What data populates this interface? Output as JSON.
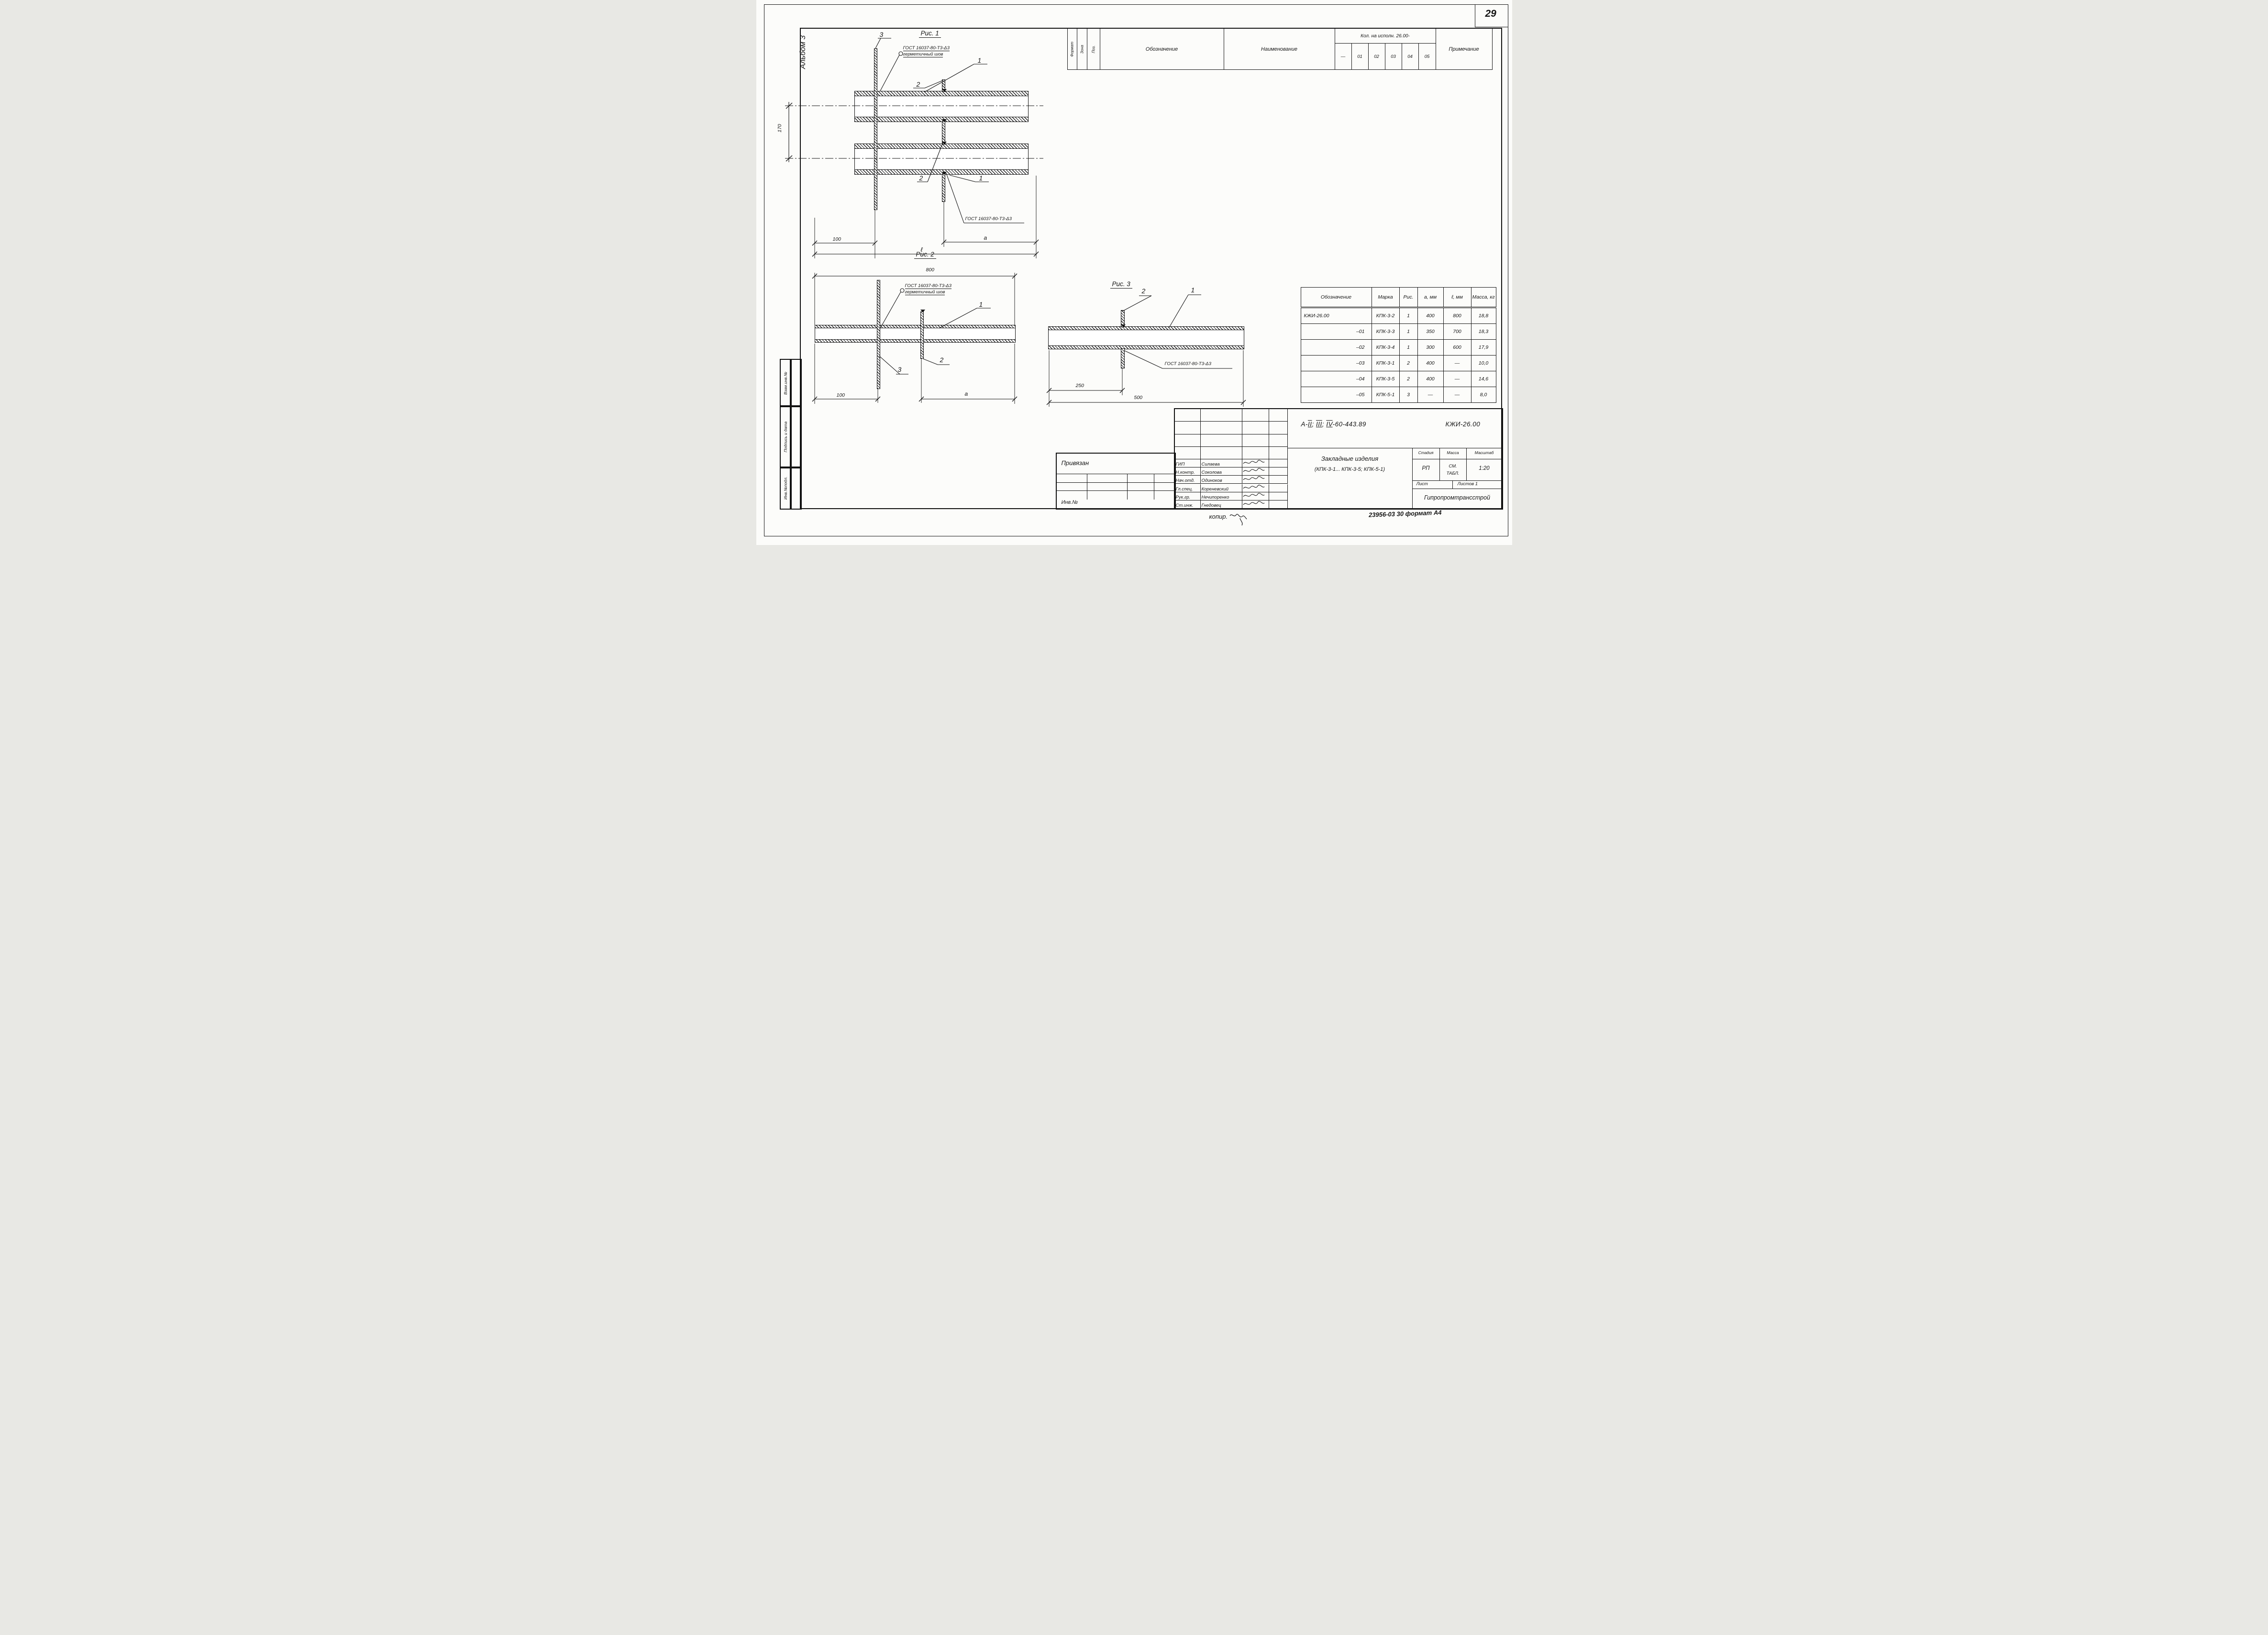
{
  "page": {
    "number": "29",
    "album": "Альбом 3",
    "copy_note": "копир.",
    "archive_code": "23956-03  30  формат А4"
  },
  "margin_stack": [
    {
      "label": "Взам.инв.№"
    },
    {
      "label": "Подпись и дата"
    },
    {
      "label": "Инв.№подл."
    }
  ],
  "spec_table": {
    "col_headers": {
      "format": "Формат",
      "zone": "Зона",
      "pos": "Поз.",
      "designation": "Обозначение",
      "name": "Наименование",
      "qty_group": "Кол. на исполн. 26.00-",
      "qty_cols": [
        "—",
        "01",
        "02",
        "03",
        "04",
        "05"
      ],
      "note": "Примечание"
    },
    "rows": [
      {
        "type": "section",
        "name": "Документация"
      },
      {
        "type": "item",
        "format": "А3",
        "zone": "",
        "pos": "",
        "designation": "КЖИ-ТТ",
        "name": "Технические требования",
        "crossed": true,
        "qty": [
          "",
          "",
          "",
          "",
          "",
          ""
        ],
        "note": ""
      },
      {
        "type": "section",
        "name": "Детали"
      },
      {
        "type": "item",
        "format": "Б.Ч.",
        "zone": "",
        "pos": "1",
        "designation": "",
        "name": "Труба",
        "frac_top": "45х2 ГОСТ 10704-76",
        "frac_bottom": "ВСт3сп ГОСТ 10705-63*",
        "qty": [
          "2",
          "2",
          "2",
          "",
          "",
          ""
        ],
        "note": ""
      },
      {
        "type": "item",
        "format": "Б.Ч.",
        "zone": "",
        "pos": "",
        "designation": "",
        "name": "Труба  15 ГОСТ 3262-75;  ℓ=800",
        "qty": [
          "",
          "",
          "",
          "1",
          "",
          ""
        ],
        "note": ""
      },
      {
        "type": "item",
        "format": "Б.Ч.",
        "zone": "",
        "pos": "",
        "designation": "",
        "name": "Труба",
        "frac_top": "57х3,5 ГОСТ 8732-78",
        "frac_bottom": "ВСт2сп ГОСТ 8731-74",
        "qty": [
          "",
          "",
          "",
          "",
          "1",
          ""
        ],
        "note": ""
      },
      {
        "type": "item",
        "format": "Б.Ч.",
        "zone": "",
        "pos": "",
        "designation": "",
        "name": "Труба",
        "frac_top": "127х4 ГОСТ 8732-78",
        "frac_bottom": "ВСт2сп ГОСТ 8731-74*",
        "qty": [
          "",
          "",
          "",
          "",
          "",
          "1"
        ],
        "note": ""
      },
      {
        "type": "item",
        "format": "",
        "zone": "",
        "pos": "2",
        "designation": "03.005-5; Т-199.250.09.001",
        "name": "Ограничитель",
        "qty": [
          "2",
          "2",
          "2",
          "",
          "",
          ""
        ],
        "note": ""
      },
      {
        "type": "item",
        "format": "",
        "zone": "",
        "pos": "",
        "designation": "″   Т-199.250.11.001",
        "name": "Ограничитель",
        "qty": [
          "",
          "",
          "",
          "1",
          "",
          ""
        ],
        "note": ""
      },
      {
        "type": "item",
        "format": "",
        "zone": "",
        "pos": "",
        "designation": "″   Т-199.250.09.001-12",
        "name": "Ограничитель",
        "qty": [
          "",
          "",
          "",
          "",
          "1",
          ""
        ],
        "note": ""
      },
      {
        "type": "item",
        "format": "",
        "zone": "",
        "pos": "",
        "designation": "КЖИ-24.00-04",
        "name": "Ограничитель О-1",
        "qty": [
          "",
          "",
          "",
          "",
          "",
          "1"
        ],
        "note": ""
      },
      {
        "type": "item",
        "format": "",
        "zone": "",
        "pos": "3",
        "designation": "–03",
        "name": "Пластина  П-5",
        "qty": [
          "1",
          "1",
          "1",
          "",
          "",
          ""
        ],
        "note": ""
      },
      {
        "type": "item",
        "format": "",
        "zone": "",
        "pos": "",
        "designation": "–02",
        "name": "″       П-4",
        "qty": [
          "",
          "",
          "",
          "1",
          "",
          ""
        ],
        "note": ""
      },
      {
        "type": "item",
        "format": "",
        "zone": "",
        "pos": "",
        "designation": "03.005-5; Т-199.250.07.003-15",
        "name": "Пластина",
        "qty": [
          "",
          "",
          "",
          "",
          "1",
          ""
        ],
        "note": ""
      }
    ]
  },
  "param_table": {
    "headers": {
      "designation": "Обозначение",
      "mark": "Марка",
      "fig": "Рис.",
      "a": "а, мм",
      "l": "ℓ, мм",
      "mass": "Масса, кг"
    },
    "rows": [
      {
        "designation": "КЖИ-26.00",
        "mark": "КПК-3-2",
        "fig": "1",
        "a": "400",
        "l": "800",
        "mass": "18,8"
      },
      {
        "designation": "–01",
        "mark": "КПК-3-3",
        "fig": "1",
        "a": "350",
        "l": "700",
        "mass": "18,3"
      },
      {
        "designation": "–02",
        "mark": "КПК-3-4",
        "fig": "1",
        "a": "300",
        "l": "600",
        "mass": "17,9"
      },
      {
        "designation": "–03",
        "mark": "КПК-3-1",
        "fig": "2",
        "a": "400",
        "l": "—",
        "mass": "10,0"
      },
      {
        "designation": "–04",
        "mark": "КПК-3-5",
        "fig": "2",
        "a": "400",
        "l": "—",
        "mass": "14,6"
      },
      {
        "designation": "–05",
        "mark": "КПК-5-1",
        "fig": "3",
        "a": "—",
        "l": "—",
        "mass": "8,0"
      }
    ]
  },
  "figures": {
    "fig1": {
      "title": "Рис. 1",
      "label_pipe": "1",
      "label_bar": "2",
      "label_plate": "3",
      "weld_gost": "ГОСТ 16037-80-Т3-Δ3",
      "weld_note": "герметичный шов",
      "gost_note": "ГОСТ 16037-80-Т3-Δ3",
      "dim_height": "170",
      "dim_left": "100",
      "dim_a": "а",
      "dim_total": "ℓ"
    },
    "fig2": {
      "title": "Рис. 2",
      "dim_top": "800",
      "label_pipe": "1",
      "label_bar": "2",
      "label_plate": "3",
      "weld_gost": "ГОСТ 16037-80-Т3-Δ3",
      "weld_note": "герметичный шов",
      "dim_left": "100",
      "dim_a": "а"
    },
    "fig3": {
      "title": "Рис. 3",
      "label_pipe": "1",
      "label_bar": "2",
      "gost_note": "ГОСТ 16037-80-Т3-Δ3",
      "dim_left": "250",
      "dim_total": "500"
    }
  },
  "title_block": {
    "doc": {
      "prefix": "А-",
      "romans": [
        "II",
        "III",
        "IV"
      ],
      "suffix": "-60-443.89",
      "code": "КЖИ-26.00"
    },
    "title": "Закладные изделия",
    "subtitle": "(КПК-3-1... КПК-3-5; КПК-5-1)",
    "stage_label": "Стадия",
    "mass_label": "Масса",
    "scale_label": "Масштаб",
    "stage": "РП",
    "mass": "СМ. ТАБЛ.",
    "scale": "1:20",
    "sheet_label": "Лист",
    "sheets_label": "Листов 1",
    "org": "Гипропромтрансстрой",
    "signatures": [
      {
        "role": "ГИП",
        "name": "Силаева"
      },
      {
        "role": "Н.контр.",
        "name": "Соколова"
      },
      {
        "role": "Нач.отд.",
        "name": "Одиноков"
      },
      {
        "role": "Гл.спец.",
        "name": "Кореневский"
      },
      {
        "role": "Рук.гр.",
        "name": "Нечипоренко"
      },
      {
        "role": "Ст.инж.",
        "name": "Гнедовец"
      }
    ]
  },
  "attach": {
    "label": "Привязан",
    "inv_label": "Инв.№"
  }
}
